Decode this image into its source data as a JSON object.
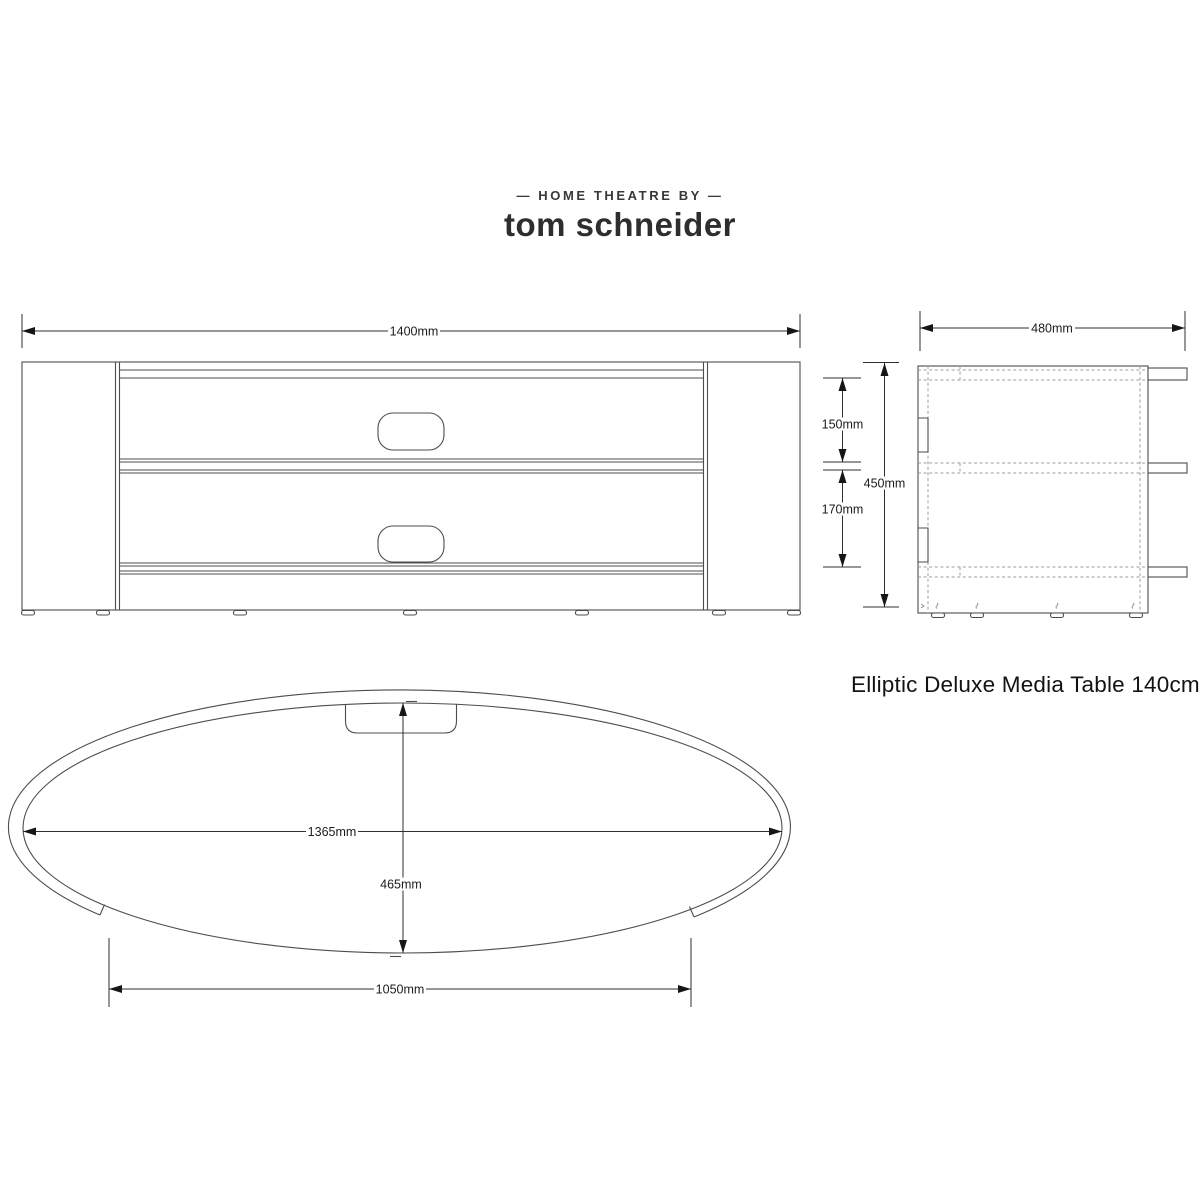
{
  "brand": {
    "tagline": "— HOME THEATRE BY —",
    "name": "tom schneider"
  },
  "title": "Elliptic Deluxe Media Table 140cm",
  "dimensions": {
    "front_width": "1400mm",
    "front_shelf_gap_top": "150mm",
    "front_shelf_gap_bottom": "170mm",
    "front_height": "450mm",
    "side_depth": "480mm",
    "top_width": "1365mm",
    "top_depth": "465mm",
    "top_front_opening": "1050mm"
  },
  "colors": {
    "background": "#ffffff",
    "object_line": "#4d4d4d",
    "dimension_line": "#2f2f2f",
    "dashed_line": "#9d9d9d",
    "label_text": "#1c1c1c",
    "brand_text": "#2e2e2e"
  }
}
